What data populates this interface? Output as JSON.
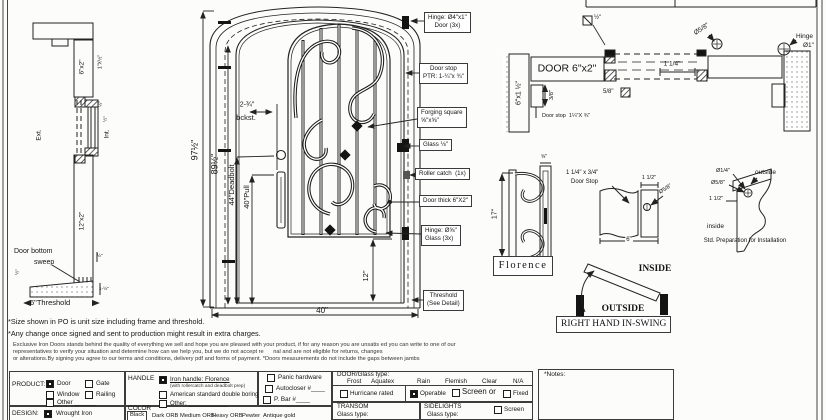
{
  "colors": {
    "ink": "#141414",
    "paper": "#fcfcfa"
  },
  "left_section": {
    "jamb_top": "6\"x2\"",
    "stop_size": "1\"X½\"",
    "ext": "Ext.",
    "int": "Int.",
    "dim_quarter": "¼\"",
    "dim_half": "½\"",
    "dim_half_left": "½\"",
    "jamb_bottom": "12\"x2\"",
    "sweep_line1": "Door bottom",
    "sweep_line2": "sweep",
    "dim_sweep": "½\"",
    "dim_threshold_h": "1-½\"",
    "threshold": "6\"Threshold"
  },
  "elevation": {
    "dims": {
      "total_height": "97½\"",
      "door_height": "89½\"",
      "deadbolt": "44\"Deadbolt",
      "pull": "40\"Pull",
      "backset_1": "2-¾\"",
      "backset_2": "bckst.",
      "bottom_glass": "12\"",
      "width": "40\""
    },
    "callouts": {
      "hinge_door_1": "Hinge: Ø4\"x1\"",
      "hinge_door_2": "Door (3x)",
      "door_stop_1": "Door stop",
      "door_stop_2": "PTR: 1-¼\"x ¾\"",
      "forging_1": "Forging square",
      "forging_2": "⅝\"x⅝\"",
      "glass": "Glass ⅛\"",
      "roller": "Roller catch  (1x)",
      "door_thick": "Door thick 6\"X2\"",
      "hinge_glass_1": "Hinge: Ø⅝\"",
      "hinge_glass_2": "Glass (3x)",
      "threshold_1": "Threshold",
      "threshold_2": "(See Detail)"
    }
  },
  "plan": {
    "door_label": "DOOR 6\"x2\"",
    "jamb": "6\"x1 ½\"",
    "dim_38": "3/8\"",
    "door_stop": "Door stop  1¼\"X ¾\"",
    "sq_half": "½\"",
    "sq_58": "5/8\"",
    "dim_114": "1 1/4\"",
    "dia_58": "Ø5/8\"",
    "hinge_1": "Hinge",
    "hinge_2": "Ø1\""
  },
  "details": {
    "scroll_height": "17\"",
    "bar_top": "⅝\"",
    "design_name": "Florence",
    "stop_label_1": "1 1/4\" x 3/4\"",
    "stop_label_2": "Door Stop",
    "stop_width": "1 1/2\"",
    "stop_dia": "Ø5/8\"",
    "stop_bottom": "6\"",
    "prep": {
      "dia_quarter": "Ø1/4\"",
      "dia_58": "Ø5/8\"",
      "dim_112": "1 1/2\"",
      "outside": "outside",
      "inside": "inside",
      "caption": "Std. Preparation for Installation"
    },
    "swing": {
      "inside": "INSIDE",
      "outside": "OUTSIDE",
      "label": "RIGHT HAND IN-SWING"
    }
  },
  "notes": {
    "note1": "*Size shown in PO is unit size including frame and threshold.",
    "note2": "*Any change once signed and sent to production might result in extra charges.",
    "fine": [
      "Exclusive Iron Doors stands behind the quality of everything we sell and hope you are pleased with your product, if for any reason you are unsatis ed you can write to one of our",
      "representatives to verify your situation and determine how can we help you, but we do not accept re      nal and are not eligible for returns, changes",
      "or alterations.By signing you agree to our terms and conditions, delivery pdf and forms of payment. *Doors measurements do not include the gaps between jambs"
    ]
  },
  "form": {
    "product": {
      "label": "PRODUCT:",
      "door": "Door",
      "gate": "Gate",
      "window": "Window",
      "railing": "Railing",
      "other": "Other ______"
    },
    "handle": {
      "label": "HANDLE",
      "iron": "Iron handle: Florence",
      "iron_sub": "(with rollercatch and deadbolt prep)",
      "american": "American standard double boring",
      "other": "Other: ____________"
    },
    "hardware": {
      "panic": "Panic hardware",
      "autocloser": "Autocloser #____",
      "pbar": "P. Bar #____"
    },
    "glass": {
      "label": "DOOR/Glass type:",
      "options": [
        "Frost",
        "Aquatex",
        "Rain",
        "Flemish",
        "Clear",
        "N/A"
      ],
      "hurricane": "Hurricane rated",
      "operable": "Operable",
      "screen_or": "Screen or",
      "fixed": "Fixed"
    },
    "notes_label": "*Notes:",
    "design": {
      "label": "DESIGN:",
      "wrought": "Wrought Iron"
    },
    "color": {
      "label": "COLOR",
      "options": [
        "Black",
        "Dark ORB",
        "Medium ORB",
        "Heavy ORB",
        "Pewter",
        "Antique gold"
      ]
    },
    "transom": {
      "label": "TRANSOM",
      "glass_type": "Glass type:"
    },
    "sidelights": {
      "label": "SIDELIGHTS",
      "glass_type": "Glass type:",
      "screen": "Screen"
    }
  }
}
